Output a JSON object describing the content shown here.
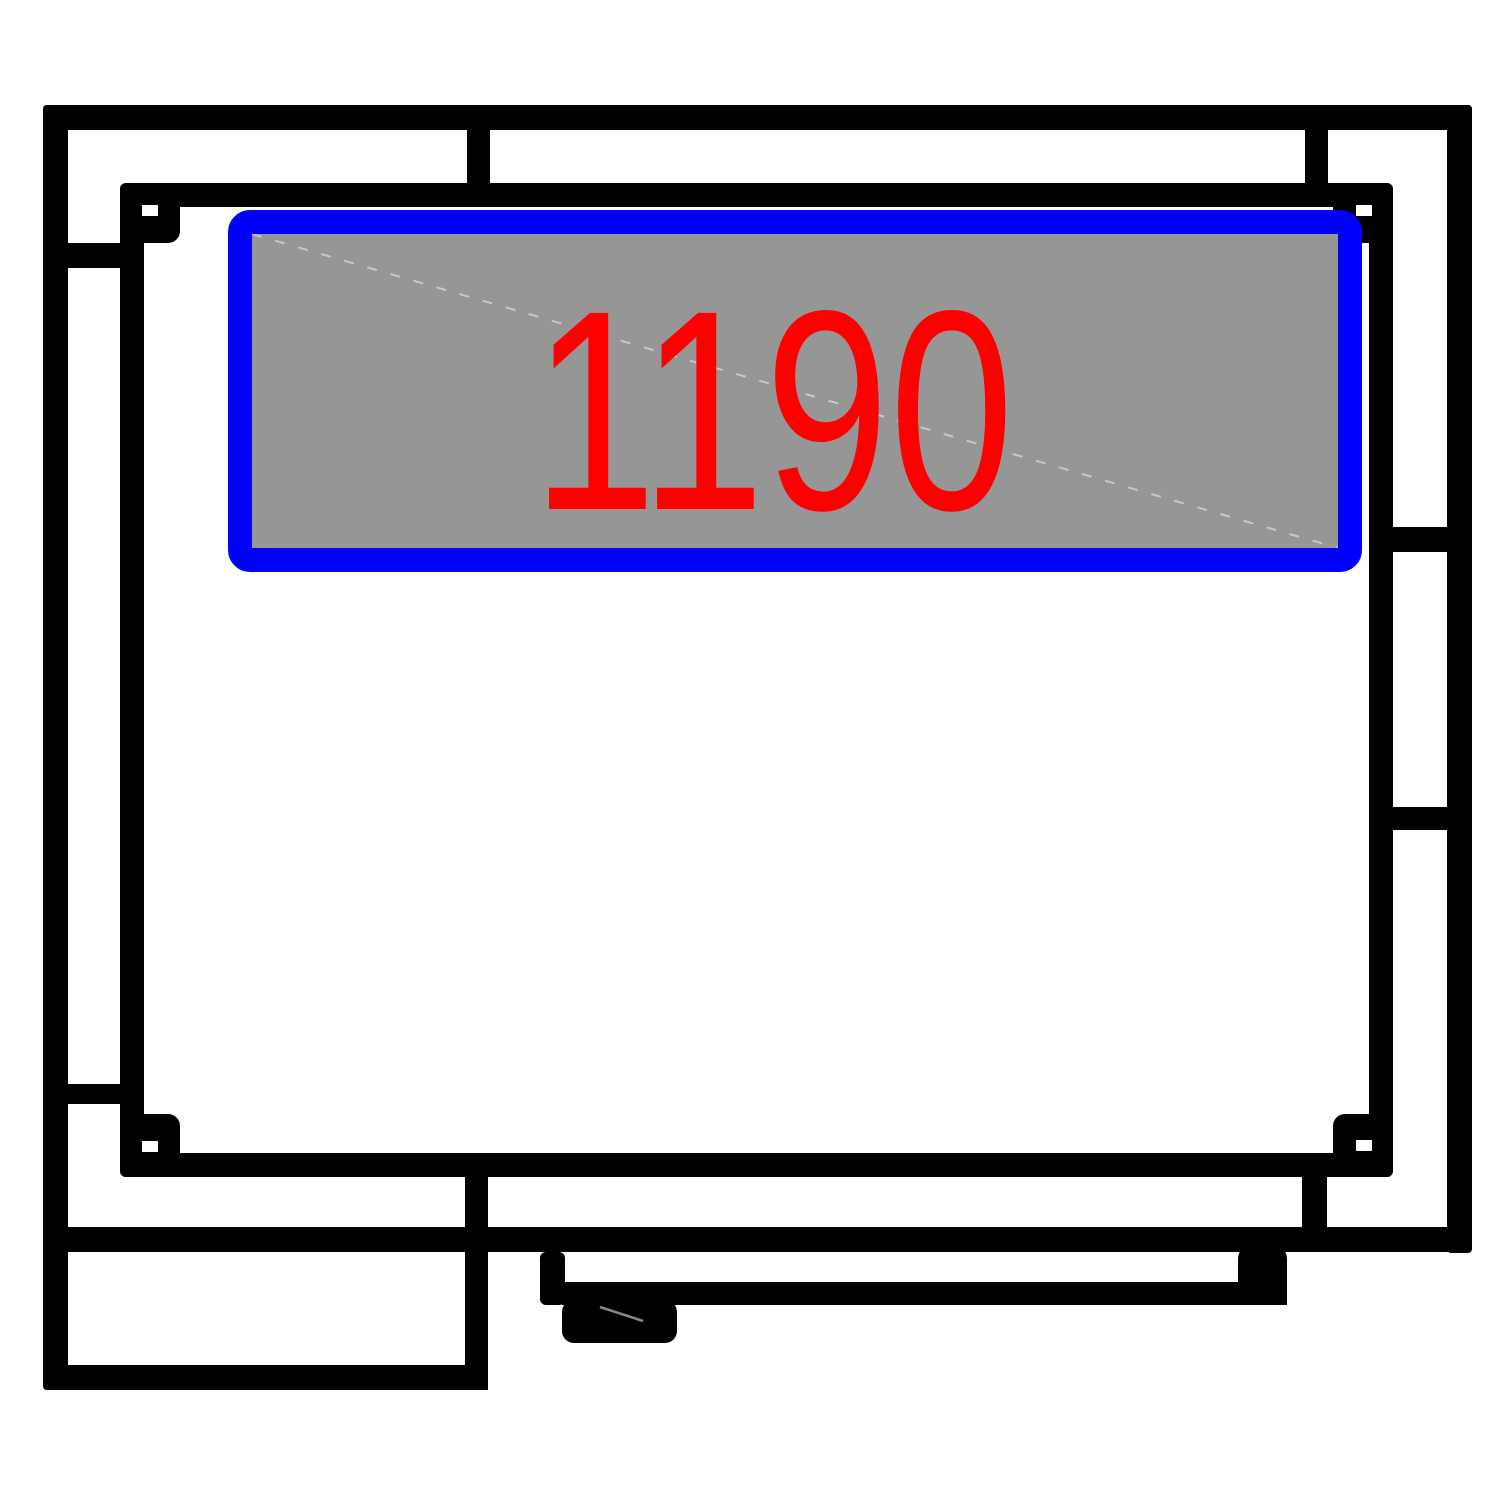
{
  "canvas": {
    "width": 1500,
    "height": 1500,
    "background": "#ffffff"
  },
  "colors": {
    "wall": "#000000",
    "window_frame": "#0000ff",
    "window_glass": "#969696",
    "dimension_text": "#ff0000",
    "glass_diagonal": "#c8c8c8",
    "handle_highlight": "#888888"
  },
  "window": {
    "dimension_label": "1190"
  }
}
